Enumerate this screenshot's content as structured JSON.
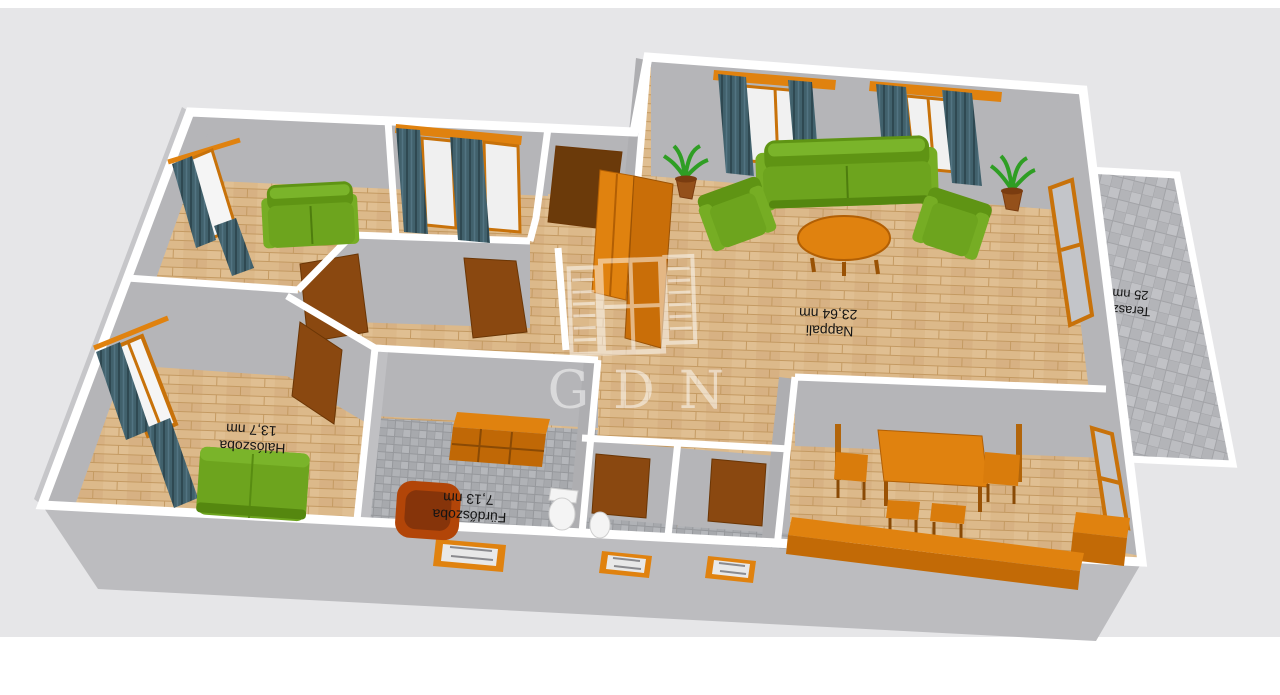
{
  "scene": {
    "description": "3D rendered floor plan of an apartment, viewed from above at an angle, labels upside down",
    "watermark": {
      "brand": "GDN"
    }
  },
  "rooms": [
    {
      "name": "Nappali",
      "area": "23,64 nm"
    },
    {
      "name": "Hálószoba",
      "area": "13,7 nm"
    },
    {
      "name": "Fürdőszoba",
      "area": "7,13 nm"
    },
    {
      "name": "Terasz",
      "area": "25 nm"
    }
  ],
  "palette": {
    "canvas": "#e6e6e8",
    "wall_cap": "#ffffff",
    "wall_face": "#b5b5b8",
    "exterior_wall": "#bcbcbf",
    "parquet": "#dcb98a",
    "bath_tile": "#a7a9ad",
    "terrace_tile": "#b3b4b8",
    "sofa_green": "#6da41e",
    "furniture_orange": "#e0820f",
    "door_brown": "#8a4810",
    "entry_door_brown": "#6b3a0a",
    "curtain_slate": "#41616c",
    "bathtub": "#b24508",
    "label_text": "#141414"
  }
}
